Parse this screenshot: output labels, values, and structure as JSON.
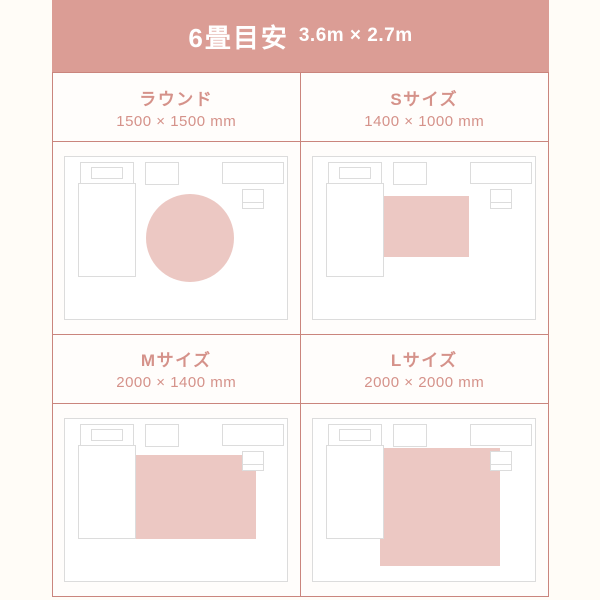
{
  "header": {
    "title": "6畳目安",
    "dimensions": "3.6m × 2.7m"
  },
  "colors": {
    "page_bg": "#fffcf7",
    "panel_bg": "#fffdfb",
    "header_bg": "#db9d95",
    "header_text": "#ffffff",
    "accent_text": "#d5928a",
    "grid_border": "#ca857d",
    "room_outline": "#dcdcdc",
    "rug_fill": "#ecc8c3",
    "furniture_fill": "#ffffff"
  },
  "cells": [
    {
      "id": "round",
      "label": "ラウンド",
      "size": "1500 × 1500 mm",
      "rug": {
        "type": "circle",
        "cx": 126,
        "cy": 82,
        "r": 44
      }
    },
    {
      "id": "size-s",
      "label": "Sサイズ",
      "size": "1400 × 1000 mm",
      "rug": {
        "type": "rect",
        "x": 72,
        "y": 40,
        "w": 85,
        "h": 61
      }
    },
    {
      "id": "size-m",
      "label": "Mサイズ",
      "size": "2000 × 1400 mm",
      "rug": {
        "type": "rect",
        "x": 72,
        "y": 37,
        "w": 120,
        "h": 84
      }
    },
    {
      "id": "size-l",
      "label": "Lサイズ",
      "size": "2000 × 2000 mm",
      "rug": {
        "type": "rect",
        "x": 68,
        "y": 30,
        "w": 120,
        "h": 118
      }
    }
  ],
  "room": {
    "width": 224,
    "height": 164,
    "furniture": [
      {
        "name": "bed-headboard",
        "x": 16,
        "y": 6,
        "w": 53,
        "h": 22
      },
      {
        "name": "bed-pillow",
        "x": 27,
        "y": 11,
        "w": 31,
        "h": 11
      },
      {
        "name": "bed",
        "x": 14,
        "y": 27,
        "w": 57,
        "h": 93
      },
      {
        "name": "tv-stand",
        "x": 81,
        "y": 6,
        "w": 33,
        "h": 22
      },
      {
        "name": "desk",
        "x": 158,
        "y": 6,
        "w": 61,
        "h": 21
      },
      {
        "name": "chair",
        "x": 178,
        "y": 33,
        "w": 21,
        "h": 19,
        "divider_y": 46
      }
    ]
  }
}
